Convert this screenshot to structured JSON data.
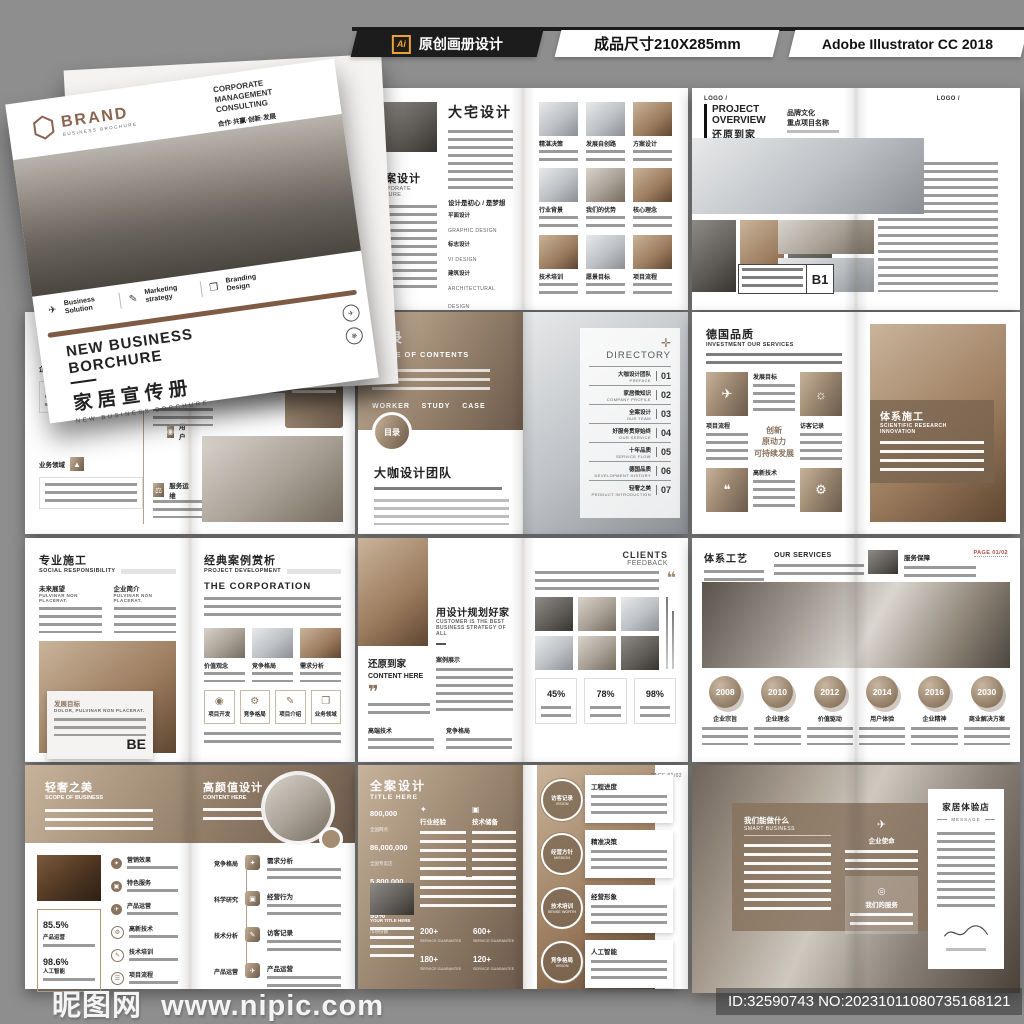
{
  "colors": {
    "accent": "#8a7460",
    "accent_dark": "#6b594a",
    "accent_light": "#c7b29b",
    "header_bg": "#1c1c1c",
    "ai_orange": "#e8a33d",
    "canvas": "#8e8e8e"
  },
  "header": {
    "ai_badge": "Ai",
    "title": "原创画册设计",
    "size_label": "成品尺寸210X285mm",
    "software": "Adobe Illustrator CC 2018"
  },
  "watermark": {
    "site": "昵图网",
    "url": "www.nipic.com"
  },
  "footer": {
    "id_text": "ID:32590743 NO:20231011080735168121"
  },
  "cover": {
    "brand": "BRAND",
    "brand_sub": "BUSINESS BROCHURE",
    "corp": "CORPORATE MANAGEMENT CONSULTING",
    "slogan": "合作·共赢·创新·发展",
    "slogan_sub": "NEW BUSINESS BROCHURE DESIGN",
    "features": [
      {
        "label": "Business Solution"
      },
      {
        "label": "Marketing strategy"
      },
      {
        "label": "Branding Design"
      }
    ],
    "title_en": "NEW BUSINESS BORCHURE",
    "title_cn": "家居宣传册",
    "subtitle_en": "NEW BUSINESS BORCHURE"
  },
  "spreads": {
    "a": {
      "title": "大宅设计",
      "section_cn": "全案设计",
      "section_en": "CORPORATE CULTURE",
      "list_title": "设计是初心 / 是梦想",
      "services": [
        {
          "cn": "平面设计",
          "en": "GRAPHIC DESIGN"
        },
        {
          "cn": "标志设计",
          "en": "VI DESIGN"
        },
        {
          "cn": "建筑设计",
          "en": "ARCHITECTURAL DESIGN"
        },
        {
          "cn": "工业设计",
          "en": "INDUSTRIAL DESIGN"
        },
        {
          "cn": "建筑工程",
          "en": "ARCHITECTURAL ENGINEERING"
        }
      ],
      "grid": [
        "精湛决策",
        "发展自创路",
        "方案设计",
        "行业背景",
        "我们的优势",
        "核心理念",
        "技术培训",
        "愿景目标",
        "项目流程"
      ]
    },
    "b": {
      "logo": "LOGO /",
      "title_en": "PROJECT OVERVIEW",
      "title_cn": "还原到家",
      "sub1": "品牌文化",
      "sub2": "重点项目名称",
      "right_heading": "工程特点",
      "badge": "B1"
    },
    "c": {
      "title": "好服务贯穿始终",
      "subtitle": "CONTENT HERE",
      "timeline": [
        "企业成长",
        "用户",
        "业务领域",
        "服务运维"
      ],
      "labels": [
        "技术分析",
        "发展目标",
        "经营行为"
      ],
      "panel": "产品优势"
    },
    "d": {
      "title_cn": "目录",
      "title_en": "TABLE OF CONTENTS",
      "tags": [
        "WORKER",
        "STUDY",
        "CASE"
      ],
      "badge": "目录",
      "section": "大咖设计团队",
      "directory": "DIRECTORY",
      "items": [
        {
          "cn": "大咖设计团队",
          "en": "PREFACE",
          "num": "01"
        },
        {
          "cn": "家居微知识",
          "en": "COMPANY PROFILE",
          "num": "02"
        },
        {
          "cn": "全案设计",
          "en": "OUR TEAM",
          "num": "03"
        },
        {
          "cn": "好服务贯穿始终",
          "en": "OUR SERVICE",
          "num": "04"
        },
        {
          "cn": "十年品质",
          "en": "SERVICE FLOW",
          "num": "05"
        },
        {
          "cn": "德国品质",
          "en": "DEVELOPMENT HISTORY",
          "num": "06"
        },
        {
          "cn": "轻奢之美",
          "en": "PRODUCT INTRODUCTION",
          "num": "07"
        }
      ]
    },
    "e": {
      "title": "德国品质",
      "subtitle": "INVESTMENT OUR SERVICES",
      "cells": [
        "发展目标",
        "项目流程",
        "访客记录",
        "高新技术"
      ],
      "center": [
        "创新",
        "原动力",
        "可持续发展"
      ],
      "right_title": "体系施工",
      "right_sub": "SCIENTIFIC RESEARCH INNOVATION"
    },
    "f": {
      "title": "专业施工",
      "subtitle": "SOCIAL RESPONSIBILITY",
      "cols": [
        {
          "cn": "未来展望",
          "en": "PULVINAR NON PLACERAT."
        },
        {
          "cn": "企业简介",
          "en": "PULVINAR NON PLACERAT."
        }
      ],
      "overlay_cn": "发展目标",
      "overlay_en": "DOLOR, PULVINAR NON PLACERAT.",
      "overlay_big": "BE",
      "right_title": "经典案例赏析",
      "right_sub": "PROJECT DEVELOPMENT",
      "right_heading": "THE CORPORATION",
      "captions": [
        "价值观念",
        "竞争格局",
        "需求分析"
      ],
      "boxes": [
        "项目开发",
        "竞争格局",
        "项目介绍",
        "业务领域"
      ]
    },
    "g": {
      "title": "用设计规划好家",
      "subtitle": "CUSTOMER IS THE BEST BUSINESS STRATEGY OF ALL",
      "section": "还原到家",
      "section_sub": "CONTENT HERE",
      "label1": "案例展示",
      "label2": "高端技术",
      "label3": "竞争格局",
      "right_title": "CLIENTS",
      "right_sub": "FEEDBACK",
      "stats": [
        "45%",
        "78%",
        "98%"
      ]
    },
    "h": {
      "title": "体系工艺",
      "subtitle": "OUR SERVICES",
      "right_label": "服务保障",
      "page": "PAGE 01/02",
      "years": [
        {
          "year": "2008",
          "label": "企业宗旨"
        },
        {
          "year": "2010",
          "label": "企业理念"
        },
        {
          "year": "2012",
          "label": "价值驱动"
        },
        {
          "year": "2014",
          "label": "用户体验"
        },
        {
          "year": "2016",
          "label": "企业精神"
        },
        {
          "year": "2030",
          "label": "商业解决方案"
        }
      ]
    },
    "i": {
      "band_left_cn": "轻奢之美",
      "band_left_en": "SCOPE OF BUSINESS",
      "band_right_cn": "高颜值设计",
      "band_right_en": "CONTENT HERE",
      "stats": [
        {
          "num": "85.5%",
          "label": "产品运营"
        },
        {
          "num": "98.6%",
          "label": "人工智能"
        }
      ],
      "list": [
        "营销效果",
        "特色服务",
        "产品运营",
        "高新技术",
        "技术培训",
        "项目流程"
      ],
      "timeline_left": [
        "竞争格局",
        "科学研究",
        "技术分析",
        "产品运营"
      ],
      "timeline_right": [
        "需求分析",
        "经营行为",
        "访客记录",
        "产品运营"
      ]
    },
    "j": {
      "title": "全案设计",
      "subtitle": "TITLE HERE",
      "page": "PAGE 01/02",
      "stats": [
        {
          "num": "800,000",
          "label": "全国网点"
        },
        {
          "num": "86,000,000",
          "label": "全国专卖店"
        },
        {
          "num": "5,800,000",
          "label": "电商代理"
        },
        {
          "num": "95%",
          "label": "市场份额"
        }
      ],
      "cols": [
        "行业经验",
        "技术储备"
      ],
      "photo_label": "YOUR TITLE HERE",
      "counters": [
        {
          "num": "200+",
          "label": "SERVICE GUARANTEE"
        },
        {
          "num": "600+",
          "label": "SERVICE GUARANTEE"
        },
        {
          "num": "180+",
          "label": "SERVICE GUARANTEE"
        },
        {
          "num": "120+",
          "label": "SERVICE GUARANTEE"
        }
      ],
      "circles": [
        {
          "cn": "访客记录",
          "en": "VISION"
        },
        {
          "cn": "经营方针",
          "en": "MISSION"
        },
        {
          "cn": "技术培训",
          "en": "SENSE WORTH"
        },
        {
          "cn": "竞争格局",
          "en": "VISION"
        }
      ],
      "cards": [
        "工程进度",
        "精准决策",
        "经营形象",
        "人工智能"
      ]
    },
    "k": {
      "block1_cn": "我们能做什么",
      "block1_en": "SMART BUSINESS",
      "block2": "企业使命",
      "block3": "我们的服务",
      "panel_title": "家居体验店",
      "panel_sub": "MESSAGE"
    }
  }
}
